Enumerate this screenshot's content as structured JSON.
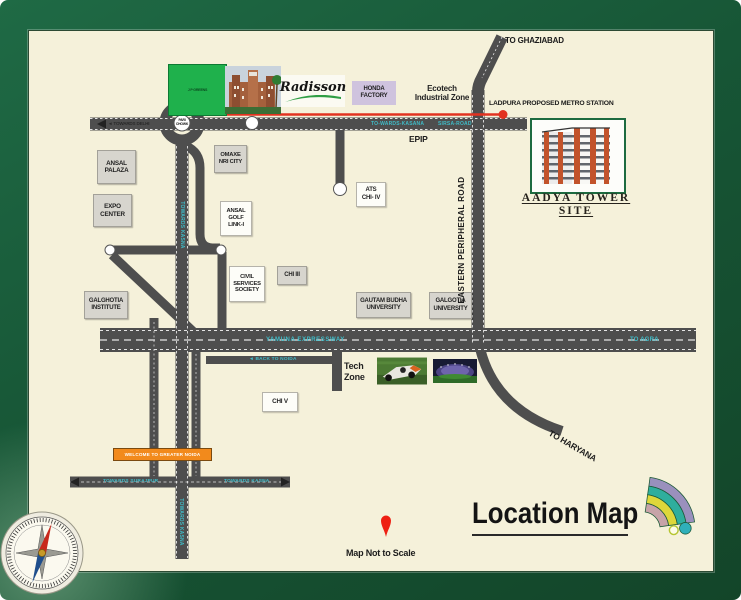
{
  "colors": {
    "frame_green": "#175636",
    "panel_cream": "#f5f1da",
    "road_grey": "#4e4e4e",
    "metro_red": "#e23220",
    "road_label_teal": "#3fbcc8",
    "sign_orange": "#f28a1c",
    "site_border_green": "#1d6b40"
  },
  "labels": {
    "jp_greens": "J P GREENS",
    "pari_chowk": "PARI\nCHOWK",
    "radisson": "Radisson",
    "honda": "HONDA\nFACTORY",
    "ecotech": "Ecotech\nIndustrial Zone",
    "to_ghaziabad": "TO GHAZIABAD",
    "ladpura": "LADPURA  PROPOSED METRO STATION",
    "epip": "EPIP",
    "ansal_palaza": "ANSAL\nPALAZA",
    "expo_center": "EXPO\nCENTER",
    "omaxe": "OMAXE\nNRI CITY",
    "ansal_golf": "ANSAL\nGOLF\nLINK-I",
    "ats_chi": "ATS\nCHI- IV",
    "chi_iii": "CHI III",
    "civil_services": "CIVIL\nSERVICES\nSOCIETY",
    "galghotia_institute": "GALGHOTIA\nINSTITUTE",
    "gautam_budha": "GAUTAM BUDHA\nUNIVERSITY",
    "galgotia_university": "GALGOTIA\nUNIVERSITY",
    "chi_v": "CHI V",
    "tech_zone": "Tech\nZone",
    "to_haryana": "TO HARYANA",
    "welcome": "WELCOME TO GREATER NOIDA"
  },
  "roads": {
    "towards_delhi": "◄ TOWARDS DELHI",
    "towards_kasana": "TO-WARDS-KASANA",
    "sirsa_road": "SIRSA-ROAD",
    "eastern_peripheral": "EASTERN PERIPHERAL ROAD",
    "yamuna": "YAMUNA EXPRESSWAY",
    "to_agra": "TO AGRA",
    "back_to_noida": "◄ BACK TO NOIDA",
    "towards_surajpur": "TOWARDS SURAJPUR",
    "towards_kasna": "TOWARDS KASNA",
    "towards_kasna_vertical": "TOWARDS KASNA",
    "towards_kasna_bottom": "TOWARDS KASNA"
  },
  "site": {
    "name_line1": "AADYA TOWER",
    "name_line2": "SITE"
  },
  "footer": {
    "title": "Location Map",
    "note": "Map Not to Scale"
  }
}
